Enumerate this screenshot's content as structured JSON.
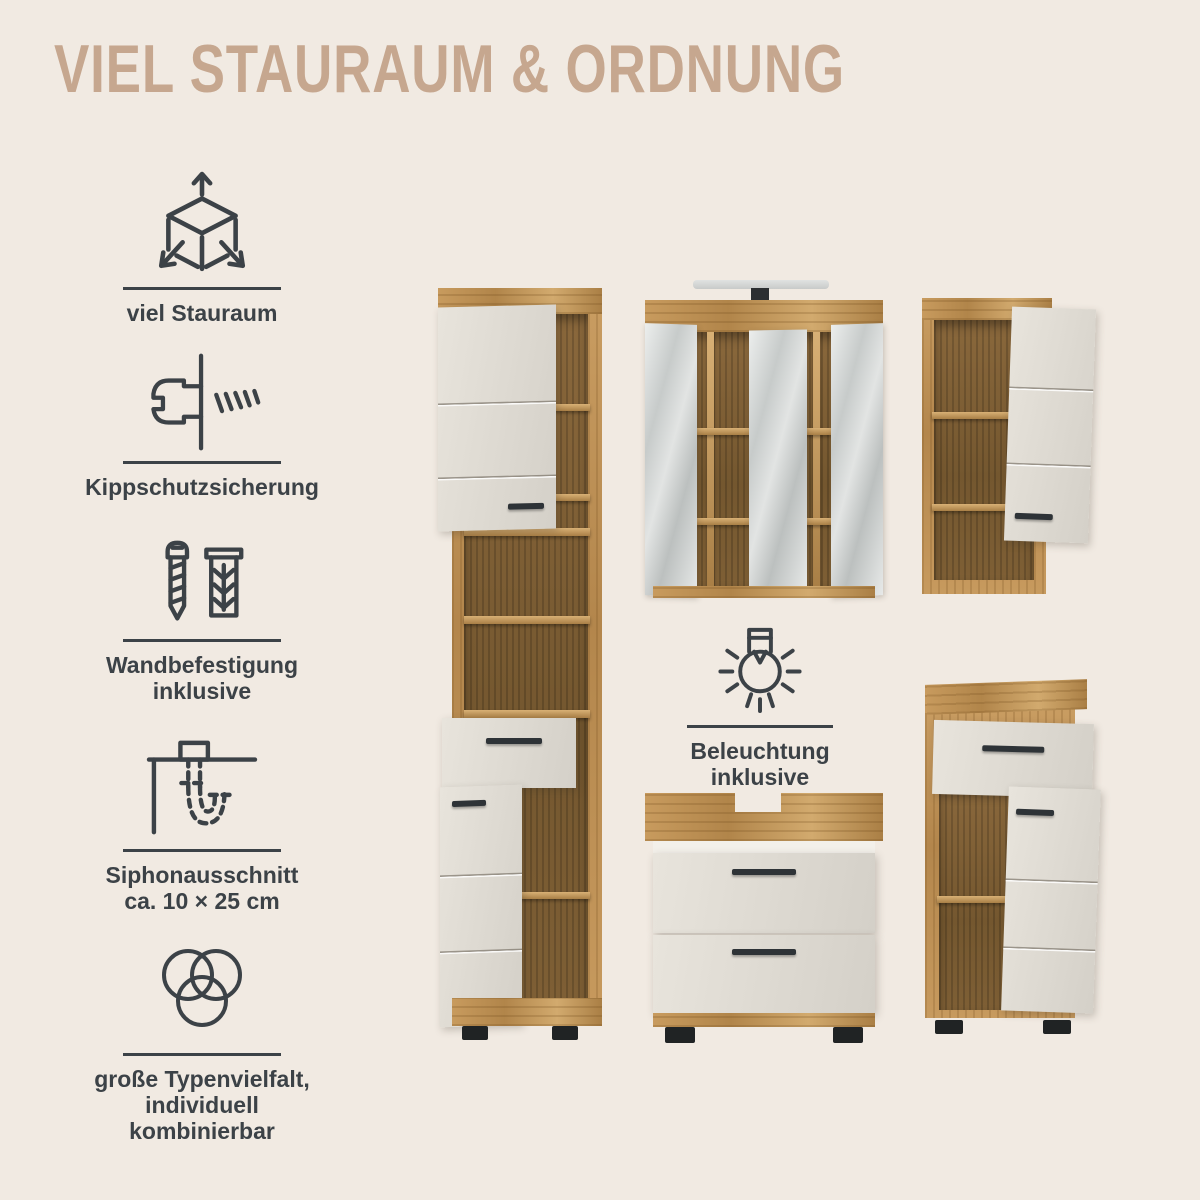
{
  "page": {
    "title": "VIEL STAURAUM & ORDNUNG",
    "background": "#f1eae2",
    "accent": "#c6a78f",
    "ink": "#3c4247"
  },
  "features": [
    {
      "icon": "cube-dimensions-icon",
      "lines": [
        "viel Stauraum",
        ""
      ]
    },
    {
      "icon": "anti-tip-fitting-icon",
      "lines": [
        "Kippschutzsicherung",
        ""
      ]
    },
    {
      "icon": "screw-and-dowel-icon",
      "lines": [
        "Wandbefestigung",
        "inklusive"
      ]
    },
    {
      "icon": "siphon-cutout-icon",
      "lines": [
        "Siphonausschnitt",
        "ca. 10 × 25 cm"
      ]
    },
    {
      "icon": "venn-circles-icon",
      "lines": [
        "große Typenvielfalt,",
        "individuell kombinierbar"
      ]
    }
  ],
  "lighting_feature": {
    "icon": "light-bulb-icon",
    "lines": [
      "Beleuchtung",
      "inklusive"
    ]
  },
  "furniture": [
    {
      "name": "tall-cabinet"
    },
    {
      "name": "mirror-cabinet-with-light"
    },
    {
      "name": "wall-cabinet"
    },
    {
      "name": "washbasin-vanity"
    },
    {
      "name": "floor-cabinet"
    }
  ]
}
